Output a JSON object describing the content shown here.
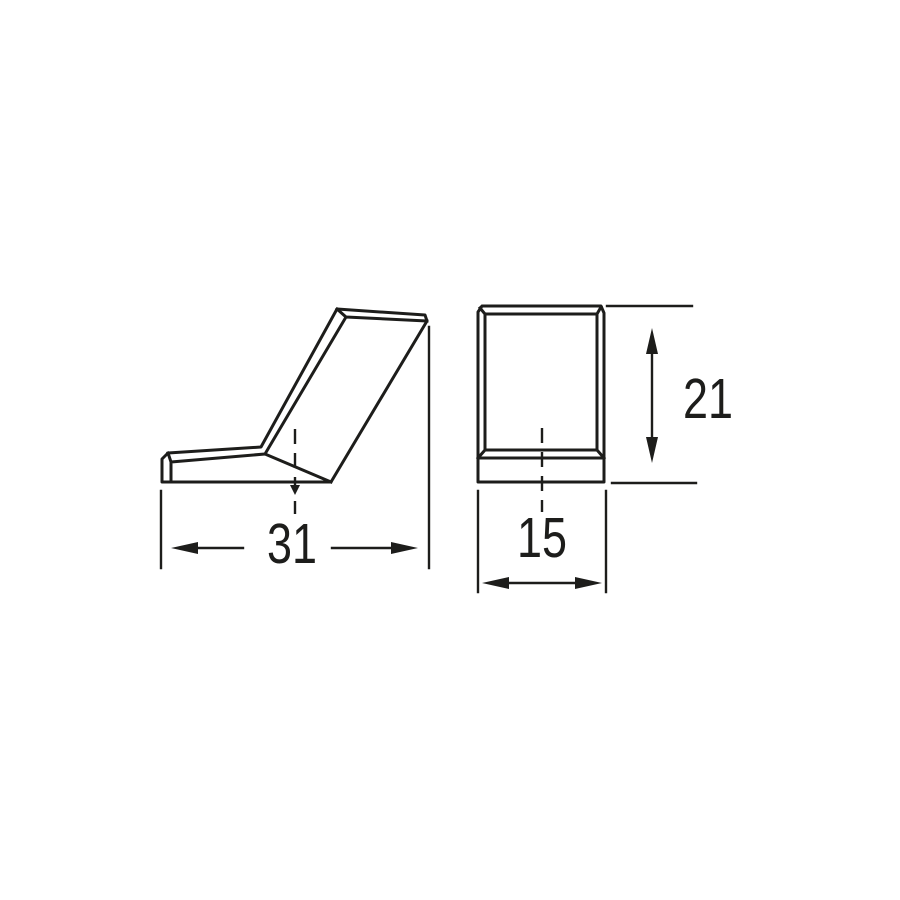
{
  "colors": {
    "background": "#ffffff",
    "line": "#1d1d1b"
  },
  "views": {
    "side": {
      "dimensions": {
        "width": {
          "value": "31"
        }
      }
    },
    "front": {
      "dimensions": {
        "width": {
          "value": "15"
        },
        "height": {
          "value": "21"
        }
      }
    }
  }
}
